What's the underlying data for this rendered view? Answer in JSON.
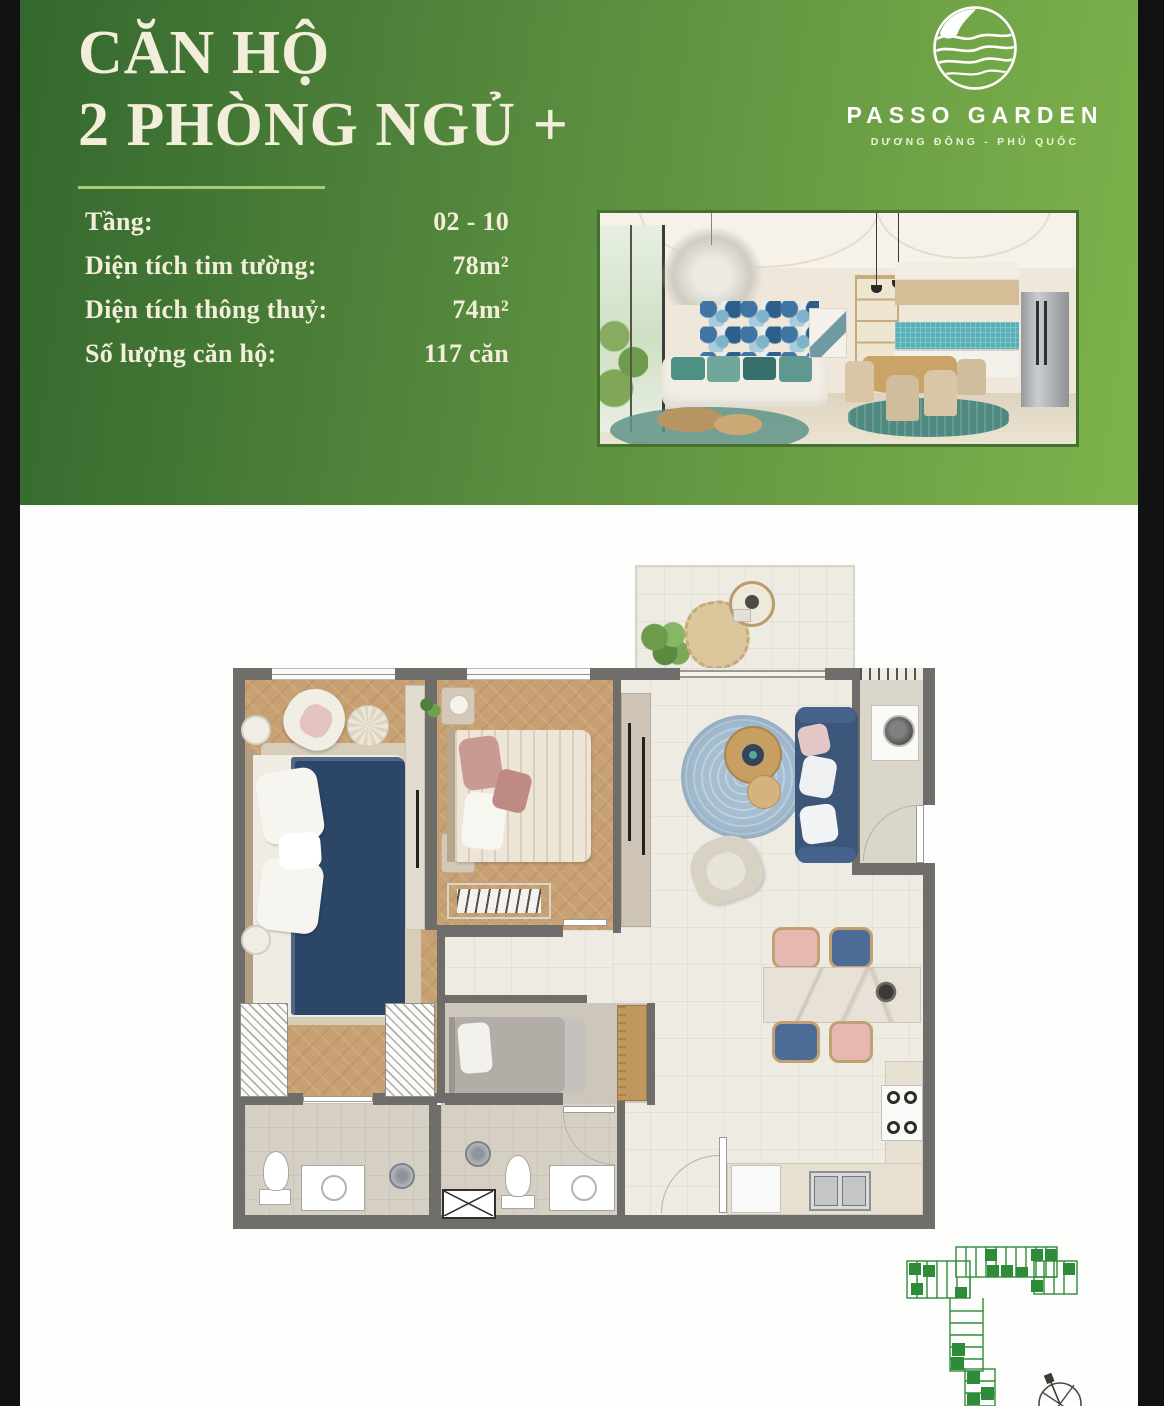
{
  "palette": {
    "green-dark": "#34682e",
    "green-mid": "#5d9040",
    "green-light": "#7fb34b",
    "cream": "#f2eeda",
    "underline": "#a9c973",
    "wall": "#6e6d6a",
    "wood": "#c7a172",
    "tile": "#eeebe3",
    "bath": "#d6d0c4",
    "navy": "#2c4668",
    "rug": "#a6bed1",
    "sofa": "#3c5679",
    "chair-pink": "#e5b8b2",
    "chair-blue": "#4c6c97",
    "site-green": "#2e8b3a"
  },
  "header": {
    "title_line1": "CĂN HỘ",
    "title_line2": "2 PHÒNG NGỦ +",
    "details": [
      {
        "label": "Tầng:",
        "value": "02 - 10"
      },
      {
        "label": "Diện tích tim tường:",
        "value": "78m²"
      },
      {
        "label": "Diện tích thông thuỷ:",
        "value": "74m²"
      },
      {
        "label": "Số lượng căn hộ:",
        "value": "117 căn"
      }
    ],
    "logo": {
      "name": "PASSO GARDEN",
      "subtitle": "DƯƠNG ĐÔNG - PHÚ QUỐC",
      "icon": "wave-hill-circle-icon"
    }
  }
}
